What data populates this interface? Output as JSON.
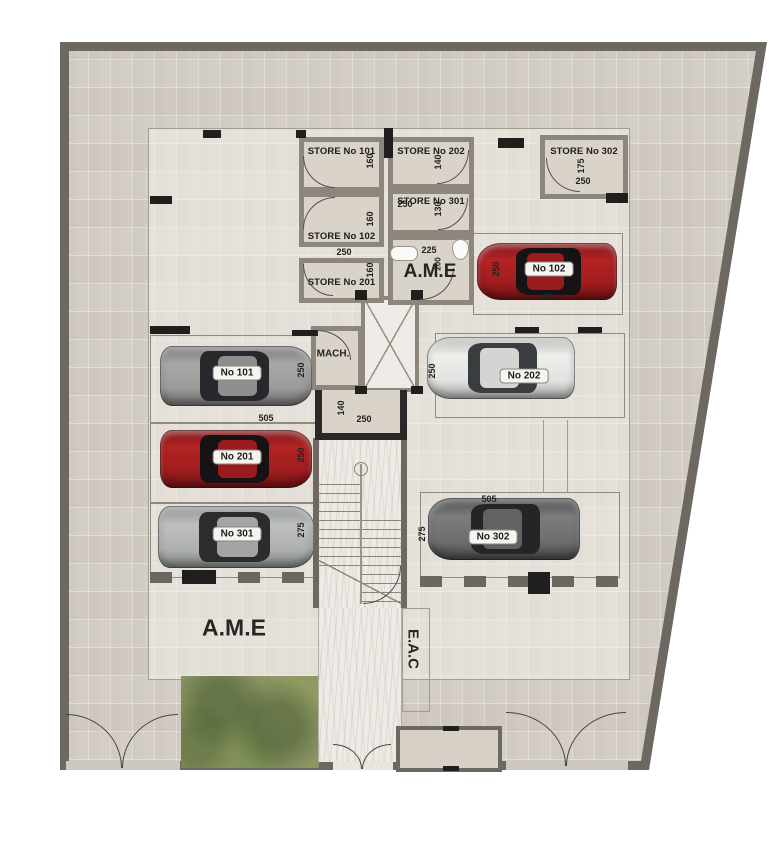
{
  "plan_title": "Basement parking floor plan",
  "stores": [
    {
      "label": "STORE No 101",
      "dims": {
        "h": "160"
      }
    },
    {
      "label": "STORE No 102",
      "dims": {
        "h": "160"
      }
    },
    {
      "label": "STORE No 201",
      "dims": {
        "h": "160",
        "w": "250"
      }
    },
    {
      "label": "STORE No 202",
      "dims": {
        "h": "140"
      }
    },
    {
      "label": "STORE No 301",
      "dims": {
        "w": "250",
        "h": "130"
      }
    },
    {
      "label": "STORE No 302",
      "dims": {
        "h": "175",
        "w": "250"
      }
    }
  ],
  "service": {
    "mach_label": "MACH.",
    "ame_room": {
      "label": "A.M.E",
      "dim_w": "225",
      "dim_h": "200"
    },
    "lobby": {
      "dim_h": "140",
      "dim_w": "250"
    }
  },
  "parking": [
    {
      "label": "No 101",
      "dim_w": "505",
      "dim_h": "250",
      "car_color": "silver"
    },
    {
      "label": "No 201",
      "dim_h": "250",
      "car_color": "red"
    },
    {
      "label": "No 301",
      "dim_h": "275",
      "car_color": "silver"
    },
    {
      "label": "No 102",
      "dim_h": "250",
      "dim_w": "450",
      "car_color": "red"
    },
    {
      "label": "No 202",
      "dim_h": "250",
      "car_color": "white"
    },
    {
      "label": "No 302",
      "dim_w": "505",
      "dim_h": "275",
      "car_color": "dark-gray"
    }
  ],
  "areas": {
    "ame": "A.M.E",
    "eac": "E.A.C"
  },
  "colors": {
    "boundary_wall": "#6e6862",
    "room_wall": "#8d867c",
    "tile_floor": "#d8d3cb",
    "marble_floor": "#edebe5",
    "garden_green": "#8a9562",
    "car_red": "#a21e20",
    "car_silver": "#9b9b99",
    "car_white": "#e8e8e6",
    "car_dark": "#6e7072"
  }
}
